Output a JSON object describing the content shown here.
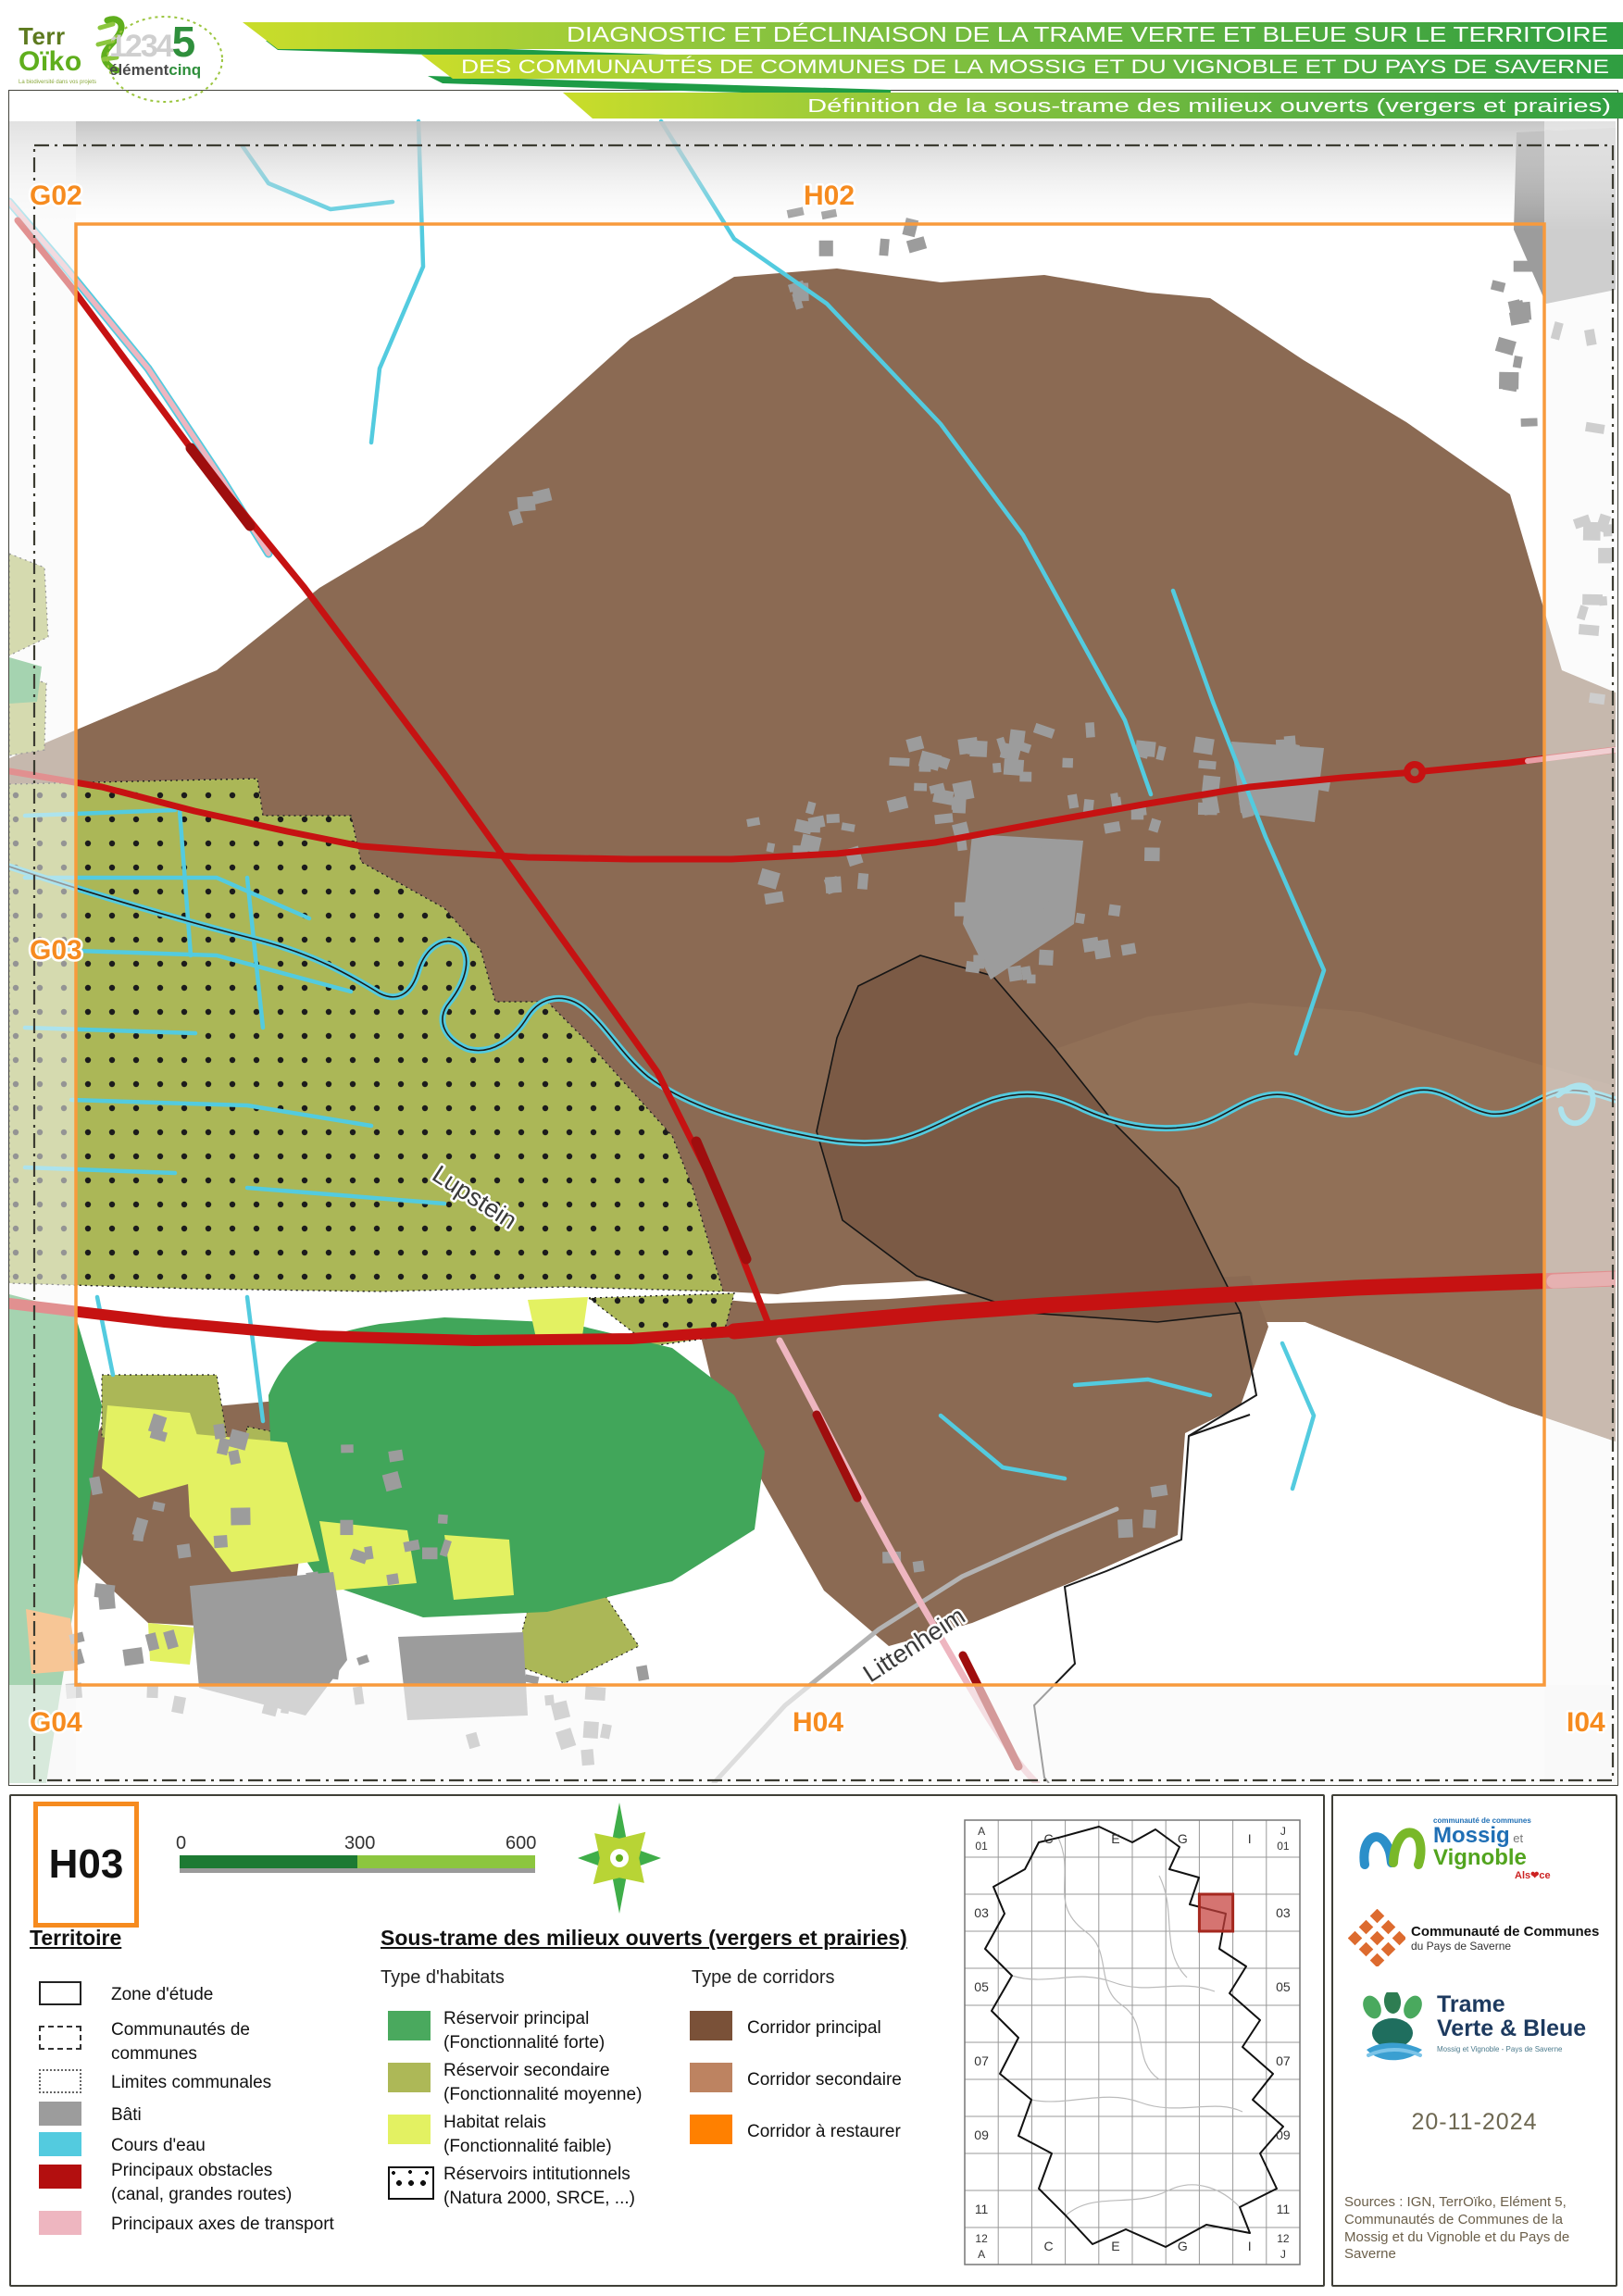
{
  "palette": {
    "header_green_light": "#cadd2a",
    "header_green_dark": "#2f9e41",
    "header_connector": "#1e9c46",
    "corridor_principal": "#7a5138",
    "corridor_secondaire": "#bd8361",
    "corridor_restaurer": "#ff8000",
    "map_brown_main": "#8b6a53",
    "map_brown_dark": "#7b5a45",
    "reservoir_principal": "#4aa95e",
    "reservoir_secondaire": "#adb857",
    "habitat_relais": "#e3f162",
    "cours_eau": "#53cbdf",
    "bati": "#9c9c9c",
    "obstacle_red": "#c61212",
    "axe_transport": "#eeb6c0",
    "frame_orange": "#f89a3c",
    "grid_label_orange": "#f68b1f"
  },
  "header": {
    "line1": "DIAGNOSTIC ET DÉCLINAISON DE LA TRAME VERTE ET BLEUE SUR LE TERRITOIRE",
    "line2": "DES COMMUNAUTÉS DE COMMUNES DE LA MOSSIG ET DU VIGNOBLE ET DU PAYS DE SAVERNE",
    "line3": "Définition de la sous-trame des milieux ouverts (vergers et prairies)",
    "logo_terroiko_line1": "Terr",
    "logo_terroiko_line2": "Oïko",
    "logo_terroiko_tag": "La biodiversité dans vos projets",
    "logo_element_digits": "1234",
    "logo_element_digit5": "5",
    "logo_element_name": "élément",
    "logo_element_name2": "cinq"
  },
  "map": {
    "grid_labels": {
      "g02": "G02",
      "h02": "H02",
      "g03": "G03",
      "g04": "G04",
      "h04": "H04",
      "i04": "I04"
    },
    "places": {
      "lupstein": "Lupstein",
      "littenheim": "Littenheim"
    }
  },
  "legend": {
    "sheet_id": "H03",
    "scale": {
      "t0": "0",
      "t300": "300",
      "t600": "600 m"
    },
    "territoire": {
      "title": "Territoire",
      "items": [
        {
          "label": "Zone d'étude"
        },
        {
          "label": "Communautés de",
          "label2": "communes"
        },
        {
          "label": "Limites communales"
        },
        {
          "label": "Bâti"
        },
        {
          "label": "Cours d'eau"
        },
        {
          "label": "Principaux obstacles",
          "label2": "(canal, grandes routes)"
        },
        {
          "label": "Principaux axes de transport"
        }
      ]
    },
    "soustrame": {
      "title": "Sous-trame des milieux ouverts (vergers et prairies)",
      "habitats_title": "Type d'habitats",
      "habitats": [
        {
          "label": "Réservoir principal",
          "label2": "(Fonctionnalité forte)"
        },
        {
          "label": "Réservoir secondaire",
          "label2": "(Fonctionnalité moyenne)"
        },
        {
          "label": "Habitat relais",
          "label2": "(Fonctionnalité faible)"
        },
        {
          "label": "Réservoirs intitutionnels",
          "label2": "(Natura 2000, SRCE, ...)"
        }
      ],
      "corridors_title": "Type de corridors",
      "corridors": [
        {
          "label": "Corridor principal"
        },
        {
          "label": "Corridor secondaire"
        },
        {
          "label": "Corridor à restaurer"
        }
      ]
    }
  },
  "index_map": {
    "col_labels": [
      "C",
      "E",
      "G",
      "I"
    ],
    "row_labels": [
      "03",
      "05",
      "07",
      "09",
      "11"
    ],
    "corner_tl": [
      "A",
      "01"
    ],
    "corner_tr": [
      "J",
      "01"
    ],
    "corner_bl": [
      "12",
      "A"
    ],
    "corner_br": [
      "12",
      "J"
    ]
  },
  "credits": {
    "mossig_small": "communauté de communes",
    "mossig_name1": "Mossig",
    "mossig_et": " et ",
    "mossig_name2": "Vignoble",
    "mossig_region": "Als❤ce",
    "saverne_line1": "Communauté de Communes",
    "saverne_line2": "du Pays de Saverne",
    "tvb_line1": "Trame",
    "tvb_line2": "Verte & Bleue",
    "tvb_sub": "Mossig et Vignoble - Pays de Saverne",
    "date": "20-11-2024",
    "sources": "Sources : IGN, TerrOïko, Elément 5, Communautés de Communes de la Mossig et du Vignoble et du Pays de Saverne"
  }
}
